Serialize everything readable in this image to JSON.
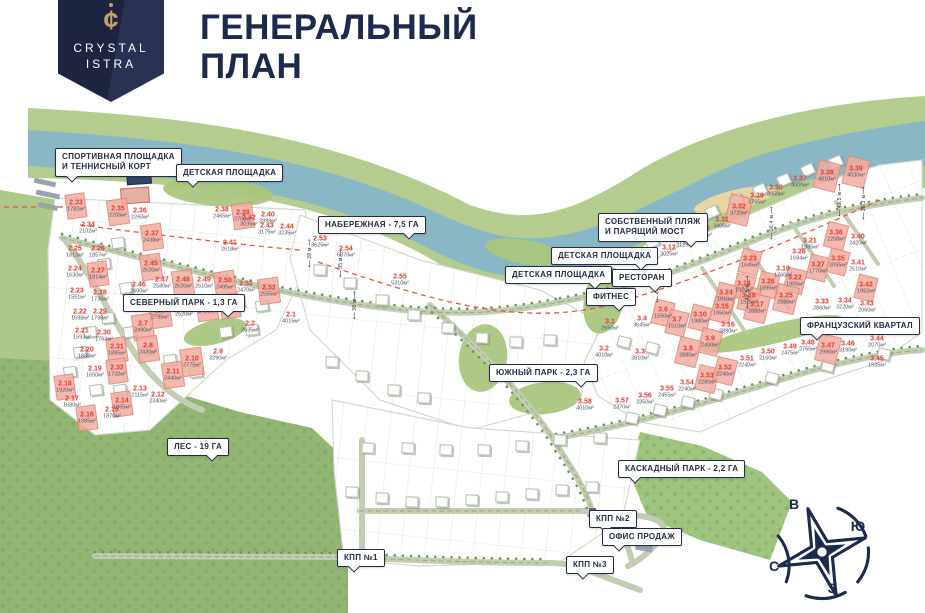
{
  "header": {
    "brand_line1": "CRYSTAL",
    "brand_line2": "ISTRA",
    "logo_glyph": "cent-crystal-icon",
    "title_line1": "ГЕНЕРАЛЬНЫЙ",
    "title_line2": "ПЛАН"
  },
  "colors": {
    "navy": "#1d2a4d",
    "accent_red": "#e23b2e",
    "plot_highlight": "#f2aca0",
    "river": "#8ab7c6",
    "bank_green": "#b4cd8f",
    "forest_green": "#8fb370",
    "gold": "#c2a266"
  },
  "map": {
    "callouts": [
      {
        "t": "СПОРТИВНАЯ ПЛОЩАДКА\nИ ТЕННИСНЫЙ КОРТ",
        "x": 55,
        "y": 148,
        "p": "l"
      },
      {
        "t": "ДЕТСКАЯ ПЛОЩАДКА",
        "x": 176,
        "y": 164,
        "p": "l"
      },
      {
        "t": "НАБЕРЕЖНАЯ - 7,5 ГА",
        "x": 318,
        "y": 216,
        "p": "r"
      },
      {
        "t": "СОБСТВЕННЫЙ ПЛЯЖ\nИ ПАРЯЩИЙ МОСТ",
        "x": 598,
        "y": 213,
        "p": "r"
      },
      {
        "t": "ДЕТСКАЯ ПЛОЩАДКА",
        "x": 551,
        "y": 247,
        "p": "r"
      },
      {
        "t": "ДЕТСКАЯ ПЛОЩАДКА",
        "x": 505,
        "y": 266,
        "p": "r"
      },
      {
        "t": "РЕСТОРАН",
        "x": 612,
        "y": 269,
        "p": "r"
      },
      {
        "t": "ФИТНЕС",
        "x": 586,
        "y": 288,
        "p": "r"
      },
      {
        "t": "СЕВЕРНЫЙ ПАРК - 1,3 ГА",
        "x": 123,
        "y": 294,
        "p": "r"
      },
      {
        "t": "ЮЖНЫЙ ПАРК - 2,3 ГА",
        "x": 489,
        "y": 364,
        "p": "r"
      },
      {
        "t": "ФРАНЦУЗСКИЙ КВАРТАЛ",
        "x": 800,
        "y": 317,
        "p": "l"
      },
      {
        "t": "ЛЕС - 19 ГА",
        "x": 167,
        "y": 438,
        "p": "r"
      },
      {
        "t": "КАСКАДНЫЙ ПАРК - 2,2 ГА",
        "x": 618,
        "y": 460,
        "p": "l"
      },
      {
        "t": "КПП №2",
        "x": 589,
        "y": 510,
        "p": "l"
      },
      {
        "t": "ОФИС ПРОДАЖ",
        "x": 602,
        "y": 528,
        "p": "l"
      },
      {
        "t": "КПП №3",
        "x": 566,
        "y": 556,
        "p": "l"
      },
      {
        "t": "КПП №1",
        "x": 337,
        "y": 549,
        "p": "l"
      }
    ],
    "plots": [
      [
        "2.33",
        "1782м²",
        76,
        206,
        1
      ],
      [
        "2.34",
        "2102м²",
        88,
        228,
        0
      ],
      [
        "2.35",
        "2205м²",
        118,
        212,
        1
      ],
      [
        "2.36",
        "2260м²",
        140,
        214,
        0
      ],
      [
        "2.37",
        "2438м²",
        152,
        237,
        1
      ],
      [
        "2.38",
        "2465м²",
        222,
        213,
        0
      ],
      [
        "2.39",
        "2700м²",
        243,
        216,
        1
      ],
      [
        "2.40",
        "2899м²",
        268,
        218,
        0
      ],
      [
        "2.41",
        "2618м²",
        230,
        246,
        0
      ],
      [
        "2.42",
        "3035м²",
        249,
        221,
        0
      ],
      [
        "2.43",
        "3175м²",
        267,
        229,
        0
      ],
      [
        "2.44",
        "3235м²",
        287,
        230,
        0
      ],
      [
        "2.25",
        "1613м²",
        75,
        252,
        0
      ],
      [
        "2.26",
        "1857м²",
        98,
        252,
        0
      ],
      [
        "2.24",
        "1630м²",
        75,
        272,
        0
      ],
      [
        "2.27",
        "1914м²",
        98,
        274,
        1
      ],
      [
        "2.23",
        "1551м²",
        77,
        294,
        0
      ],
      [
        "2.28",
        "1736м²",
        100,
        296,
        0
      ],
      [
        "2.22",
        "1698м²",
        80,
        315,
        0
      ],
      [
        "2.29",
        "1798м²",
        100,
        315,
        0
      ],
      [
        "2.21",
        "1593м²",
        82,
        334,
        0
      ],
      [
        "2.30",
        "1763м²",
        104,
        336,
        0
      ],
      [
        "2.20",
        "1688м²",
        87,
        353,
        0
      ],
      [
        "2.31",
        "1885м²",
        117,
        350,
        1
      ],
      [
        "2.19",
        "1650м²",
        95,
        372,
        0
      ],
      [
        "2.32",
        "1732м²",
        117,
        371,
        1
      ],
      [
        "2.18",
        "1920м²",
        65,
        387,
        1
      ],
      [
        "2.17",
        "1680м²",
        72,
        402,
        0
      ],
      [
        "2.16",
        "1985м²",
        87,
        418,
        1
      ],
      [
        "2.15",
        "1870м²",
        112,
        413,
        0
      ],
      [
        "2.14",
        "1865м²",
        122,
        404,
        1
      ],
      [
        "2.13",
        "2115м²",
        140,
        392,
        0
      ],
      [
        "2.12",
        "2340м²",
        158,
        398,
        0
      ],
      [
        "2.45",
        "2520м²",
        151,
        267,
        1
      ],
      [
        "2.46",
        "2600м²",
        139,
        288,
        0
      ],
      [
        "2.47",
        "2580м²",
        162,
        283,
        0
      ],
      [
        "2.48",
        "2520м²",
        183,
        283,
        1
      ],
      [
        "2.49",
        "2510м²",
        204,
        283,
        0
      ],
      [
        "2.50",
        "2495м²",
        225,
        284,
        1
      ],
      [
        "2.51",
        "2470м²",
        246,
        287,
        0
      ],
      [
        "2.52",
        "2555м²",
        269,
        291,
        1
      ],
      [
        "2.6",
        "2795м²",
        160,
        314,
        1
      ],
      [
        "2.5",
        "2520м²",
        184,
        311,
        0
      ],
      [
        "2.4",
        "2490м²",
        207,
        308,
        1
      ],
      [
        "2.3",
        "2055м²",
        230,
        306,
        1
      ],
      [
        "2.2",
        "2635м²",
        250,
        327,
        0
      ],
      [
        "2.1",
        "4015м²",
        291,
        318,
        0
      ],
      [
        "2.7",
        "2490м²",
        143,
        327,
        1
      ],
      [
        "2.8",
        "2430м²",
        148,
        349,
        1
      ],
      [
        "2.9",
        "3290м²",
        218,
        355,
        0
      ],
      [
        "2.10",
        "2775м²",
        192,
        362,
        1
      ],
      [
        "2.11",
        "2440м²",
        173,
        375,
        1
      ],
      [
        "2.53",
        "3625м²",
        320,
        242,
        0
      ],
      [
        "2.54",
        "6370м²",
        346,
        252,
        0
      ],
      [
        "2.55",
        "5310м²",
        400,
        280,
        0
      ],
      [
        "3.5",
        "3330м²",
        648,
        258,
        0
      ],
      [
        "3.12",
        "3025м²",
        669,
        251,
        0
      ],
      [
        "3.13",
        "3125м²",
        685,
        242,
        0
      ],
      [
        "3.20",
        "3290м²",
        703,
        232,
        0
      ],
      [
        "3.31",
        "3405м²",
        722,
        223,
        0
      ],
      [
        "3.32",
        "3720м²",
        739,
        210,
        1
      ],
      [
        "3.29",
        "3765м²",
        757,
        199,
        0
      ],
      [
        "3.30",
        "3850м²",
        776,
        191,
        0
      ],
      [
        "3.37",
        "4000м²",
        800,
        182,
        0
      ],
      [
        "3.38",
        "4010м²",
        827,
        176,
        1
      ],
      [
        "3.39",
        "4030м²",
        856,
        172,
        1
      ],
      [
        "3.36",
        "2208м²",
        836,
        236,
        1
      ],
      [
        "3.40",
        "2420м²",
        858,
        240,
        0
      ],
      [
        "3.21",
        "1985м²",
        810,
        244,
        0
      ],
      [
        "3.28",
        "1684м²",
        799,
        255,
        0
      ],
      [
        "3.23",
        "1645м²",
        750,
        262,
        1
      ],
      [
        "3.19",
        "1760м²",
        783,
        272,
        0
      ],
      [
        "3.27",
        "1770м²",
        818,
        268,
        1
      ],
      [
        "3.22",
        "1905м²",
        795,
        281,
        1
      ],
      [
        "3.26",
        "1895м²",
        768,
        285,
        1
      ],
      [
        "3.14",
        "1920м²",
        744,
        287,
        1
      ],
      [
        "3.24",
        "1610м²",
        726,
        296,
        1
      ],
      [
        "3.18",
        "1925м²",
        749,
        299,
        1
      ],
      [
        "3.15",
        "1950м²",
        722,
        310,
        1
      ],
      [
        "3.10",
        "1980м²",
        700,
        318,
        1
      ],
      [
        "3.35",
        "2055м²",
        838,
        262,
        1
      ],
      [
        "3.41",
        "2510м²",
        858,
        266,
        0
      ],
      [
        "3.42",
        "1952м²",
        866,
        288,
        1
      ],
      [
        "3.43",
        "2060м²",
        867,
        307,
        0
      ],
      [
        "3.34",
        "3220м²",
        845,
        304,
        0
      ],
      [
        "3.33",
        "2860м²",
        822,
        305,
        0
      ],
      [
        "3.25",
        "2888м²",
        786,
        299,
        1
      ],
      [
        "3.17",
        "2888м²",
        757,
        308,
        1
      ],
      [
        "3.16",
        "2880м²",
        728,
        328,
        0
      ],
      [
        "3.6",
        "1550м²",
        663,
        313,
        1
      ],
      [
        "3.7",
        "1510м²",
        677,
        323,
        1
      ],
      [
        "3.9",
        "2400м²",
        710,
        342,
        1
      ],
      [
        "3.8",
        "2880м²",
        688,
        352,
        1
      ],
      [
        "3.1",
        "2650м²",
        610,
        325,
        0
      ],
      [
        "3.4",
        "3645м²",
        642,
        322,
        0
      ],
      [
        "3.2",
        "4010м²",
        604,
        352,
        0
      ],
      [
        "3.3",
        "3810м²",
        640,
        355,
        0
      ],
      [
        "3.58",
        "4010м²",
        585,
        405,
        0
      ],
      [
        "3.57",
        "2370м²",
        622,
        404,
        0
      ],
      [
        "3.56",
        "2350м²",
        645,
        399,
        0
      ],
      [
        "3.55",
        "2455м²",
        667,
        392,
        0
      ],
      [
        "3.54",
        "2240м²",
        687,
        386,
        0
      ],
      [
        "3.53",
        "2280м²",
        707,
        379,
        1
      ],
      [
        "3.52",
        "2240м²",
        725,
        371,
        1
      ],
      [
        "3.51",
        "2240м²",
        747,
        362,
        0
      ],
      [
        "3.50",
        "2160м²",
        768,
        355,
        0
      ],
      [
        "3.49",
        "2475м²",
        790,
        350,
        0
      ],
      [
        "3.48",
        "2765м²",
        808,
        346,
        0
      ],
      [
        "3.47",
        "2990м²",
        828,
        349,
        1
      ],
      [
        "3.46",
        "3190м²",
        848,
        347,
        0
      ],
      [
        "3.44",
        "2070м²",
        877,
        342,
        0
      ],
      [
        "3.45",
        "1935м²",
        877,
        362,
        0
      ]
    ],
    "dimensions": [
      {
        "t": "28 м",
        "x": 310,
        "y": 253
      },
      {
        "t": "35 м",
        "x": 341,
        "y": 263
      },
      {
        "t": "38 м",
        "x": 355,
        "y": 305
      },
      {
        "t": "44,9 м",
        "x": 658,
        "y": 286
      },
      {
        "t": "42,5 м",
        "x": 748,
        "y": 292
      },
      {
        "t": "36,4 м",
        "x": 772,
        "y": 223
      },
      {
        "t": "43,5 м",
        "x": 840,
        "y": 200
      },
      {
        "t": "39,3 м",
        "x": 864,
        "y": 203
      }
    ],
    "houses": [
      [
        118,
        243
      ],
      [
        104,
        264
      ],
      [
        126,
        288
      ],
      [
        152,
        302
      ],
      [
        182,
        300
      ],
      [
        208,
        300
      ],
      [
        238,
        302
      ],
      [
        262,
        306
      ],
      [
        130,
        332
      ],
      [
        108,
        318
      ],
      [
        90,
        332
      ],
      [
        80,
        352
      ],
      [
        70,
        372
      ],
      [
        96,
        390
      ],
      [
        120,
        390
      ],
      [
        148,
        350
      ],
      [
        170,
        360
      ],
      [
        196,
        372
      ],
      [
        226,
        332
      ],
      [
        252,
        330
      ],
      [
        320,
        270
      ],
      [
        350,
        283
      ],
      [
        382,
        300
      ],
      [
        414,
        315
      ],
      [
        448,
        328
      ],
      [
        482,
        338
      ],
      [
        516,
        342
      ],
      [
        550,
        340
      ],
      [
        332,
        362
      ],
      [
        362,
        376
      ],
      [
        394,
        390
      ],
      [
        424,
        398
      ],
      [
        368,
        448
      ],
      [
        408,
        448
      ],
      [
        446,
        450
      ],
      [
        484,
        450
      ],
      [
        522,
        446
      ],
      [
        560,
        440
      ],
      [
        600,
        438
      ],
      [
        352,
        492
      ],
      [
        382,
        498
      ],
      [
        412,
        502
      ],
      [
        442,
        502
      ],
      [
        472,
        500
      ],
      [
        502,
        497
      ],
      [
        532,
        494
      ],
      [
        562,
        490
      ],
      [
        592,
        487
      ],
      [
        652,
        242
      ],
      [
        672,
        232
      ],
      [
        692,
        222
      ],
      [
        712,
        212
      ],
      [
        736,
        200
      ],
      [
        760,
        190
      ],
      [
        784,
        180
      ],
      [
        808,
        170
      ],
      [
        836,
        162
      ],
      [
        624,
        342
      ],
      [
        652,
        348
      ],
      [
        632,
        418
      ],
      [
        660,
        410
      ],
      [
        688,
        402
      ],
      [
        716,
        394
      ],
      [
        772,
        378
      ],
      [
        828,
        366
      ],
      [
        884,
        354
      ]
    ],
    "compass": {
      "letters": [
        {
          "t": "В",
          "x": 794,
          "y": 504
        },
        {
          "t": "Ю",
          "x": 858,
          "y": 526
        },
        {
          "t": "С",
          "x": 774,
          "y": 566
        },
        {
          "t": "З",
          "x": 832,
          "y": 588
        }
      ]
    }
  }
}
